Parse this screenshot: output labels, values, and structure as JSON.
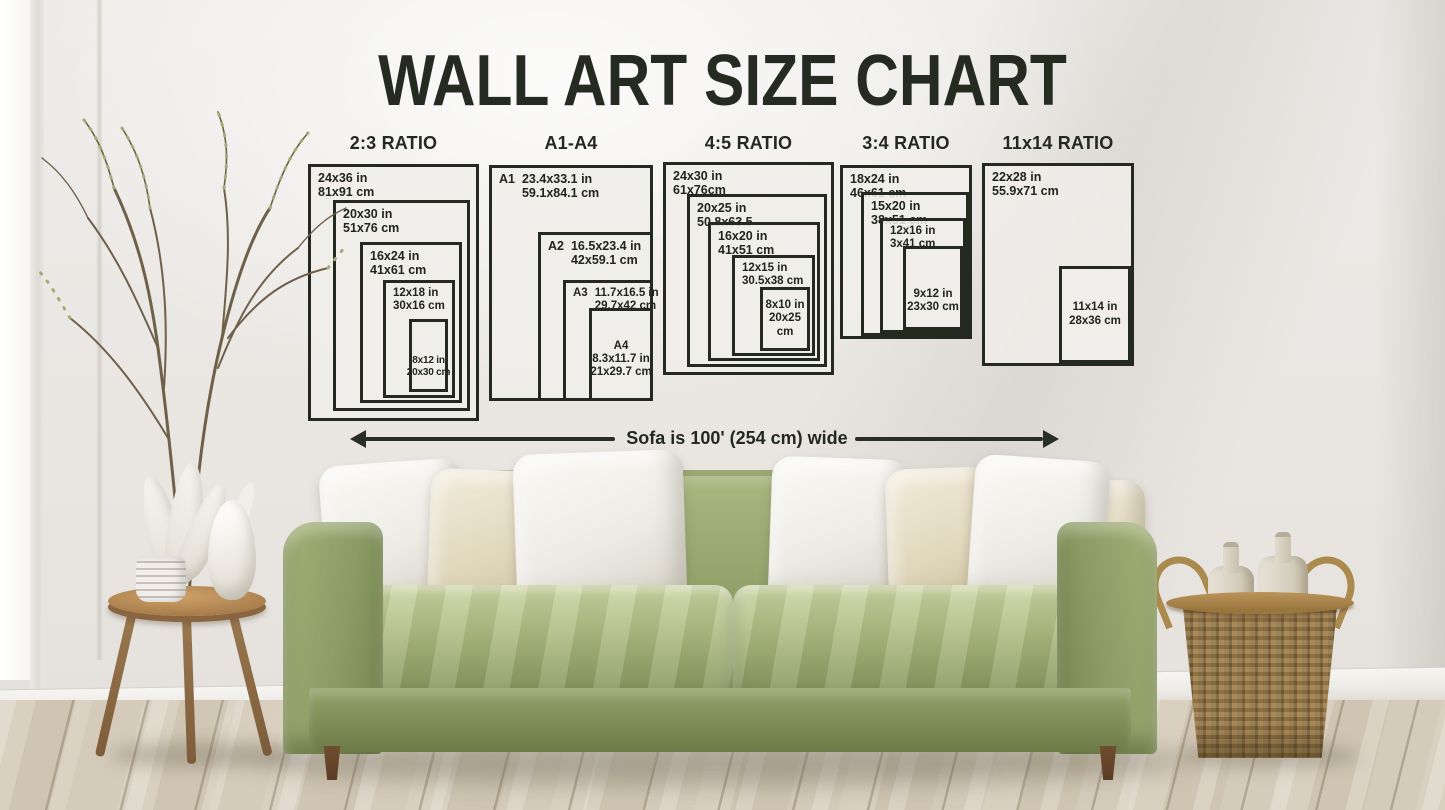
{
  "title": "WALL ART SIZE CHART",
  "sofa_note": "Sofa is 100' (254 cm) wide",
  "groups": [
    {
      "header": "2:3 RATIO",
      "boxes": [
        {
          "line1": "24x36 in",
          "line2": "81x91 cm"
        },
        {
          "line1": "20x30 in",
          "line2": "51x76 cm"
        },
        {
          "line1": "16x24 in",
          "line2": "41x61 cm"
        },
        {
          "line1": "12x18 in",
          "line2": "30x16 cm"
        },
        {
          "line1": "8x12 in",
          "line2": "20x30 cm"
        }
      ]
    },
    {
      "header": "A1-A4",
      "boxes": [
        {
          "prefix": "A1",
          "line1": "23.4x33.1 in",
          "line2": "59.1x84.1 cm"
        },
        {
          "prefix": "A2",
          "line1": "16.5x23.4 in",
          "line2": "42x59.1 cm"
        },
        {
          "prefix": "A3",
          "line1": "11.7x16.5 in",
          "line2": "29.7x42 cm"
        },
        {
          "prefix": "A4",
          "line1": "8.3x11.7 in",
          "line2": "21x29.7 cm"
        }
      ]
    },
    {
      "header": "4:5 RATIO",
      "boxes": [
        {
          "line1": "24x30 in",
          "line2": "61x76cm"
        },
        {
          "line1": "20x25 in",
          "line2": "50.8x63.5"
        },
        {
          "line1": "16x20 in",
          "line2": "41x51 cm"
        },
        {
          "line1": "12x15 in",
          "line2": "30.5x38 cm"
        },
        {
          "line1": "8x10 in",
          "line2": "20x25 cm"
        }
      ]
    },
    {
      "header": "3:4 RATIO",
      "boxes": [
        {
          "line1": "18x24 in",
          "line2": "46x61 cm"
        },
        {
          "line1": "15x20 in",
          "line2": "38x51 cm"
        },
        {
          "line1": "12x16 in",
          "line2": "3x41 cm"
        },
        {
          "line1": "9x12 in",
          "line2": "23x30 cm"
        }
      ]
    },
    {
      "header": "11x14 RATIO",
      "boxes": [
        {
          "line1": "22x28 in",
          "line2": "55.9x71 cm"
        },
        {
          "line1": "11x14 in",
          "line2": "28x36 cm"
        }
      ]
    }
  ],
  "colors": {
    "ink": "#232920",
    "box_fill": "#f0eeea",
    "sofa_green": "#93a26b",
    "wall": "#e9e6e2",
    "floor_wood": "#d2c8b6",
    "table_wood": "#a87d4b",
    "basket": "#8e7143"
  }
}
